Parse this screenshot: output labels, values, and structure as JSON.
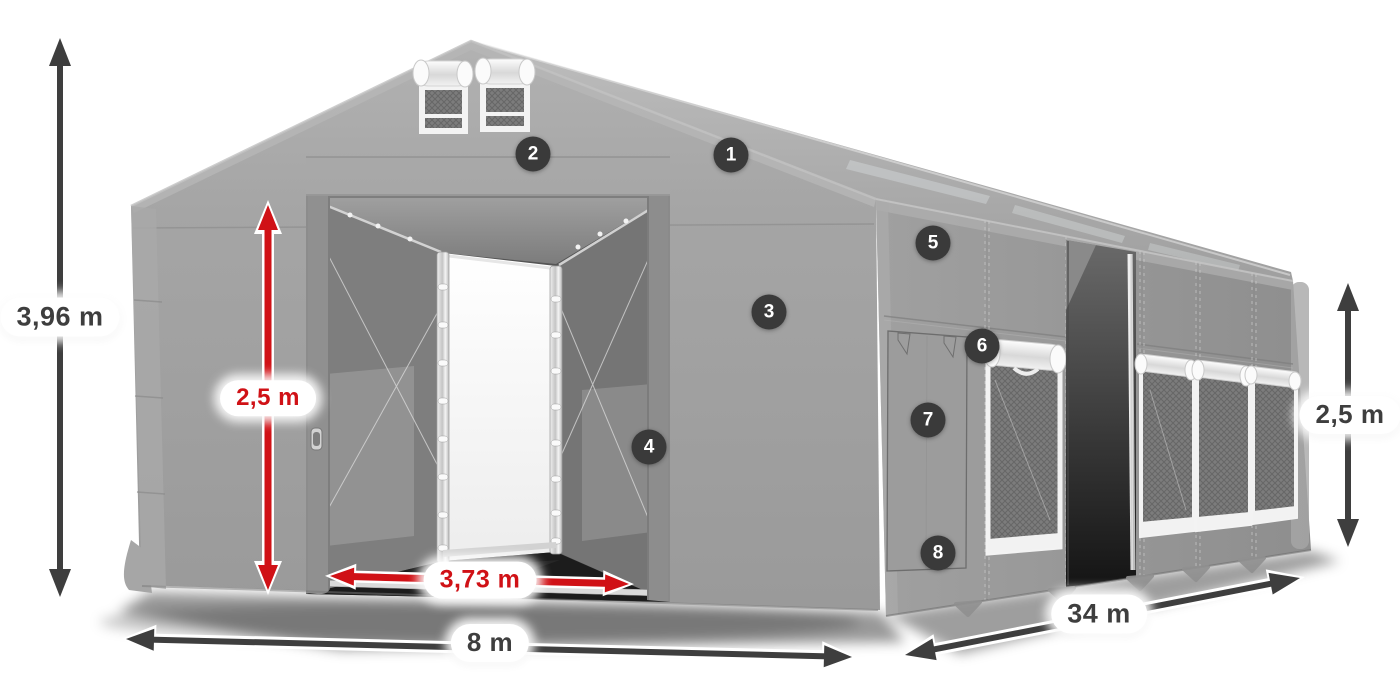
{
  "colors": {
    "dimension_dark": "#3e3e3e",
    "dimension_red": "#d01116",
    "badge_background": "#3a3a3a",
    "badge_text": "#ffffff",
    "label_background": "#ffffff",
    "tent_fabric_gray": "#9b9b9b"
  },
  "dimensions": {
    "total_height": {
      "label": "3,96 m",
      "style": "dark"
    },
    "entrance_height": {
      "label": "2,5 m",
      "style": "red"
    },
    "entrance_width": {
      "label": "3,73 m",
      "style": "red"
    },
    "front_width": {
      "label": "8 m",
      "style": "dark"
    },
    "length": {
      "label": "34 m",
      "style": "dark"
    },
    "side_wall_height": {
      "label": "2,5 m",
      "style": "dark"
    }
  },
  "callouts": [
    {
      "number": "1"
    },
    {
      "number": "2"
    },
    {
      "number": "3"
    },
    {
      "number": "4"
    },
    {
      "number": "5"
    },
    {
      "number": "6"
    },
    {
      "number": "7"
    },
    {
      "number": "8"
    }
  ]
}
